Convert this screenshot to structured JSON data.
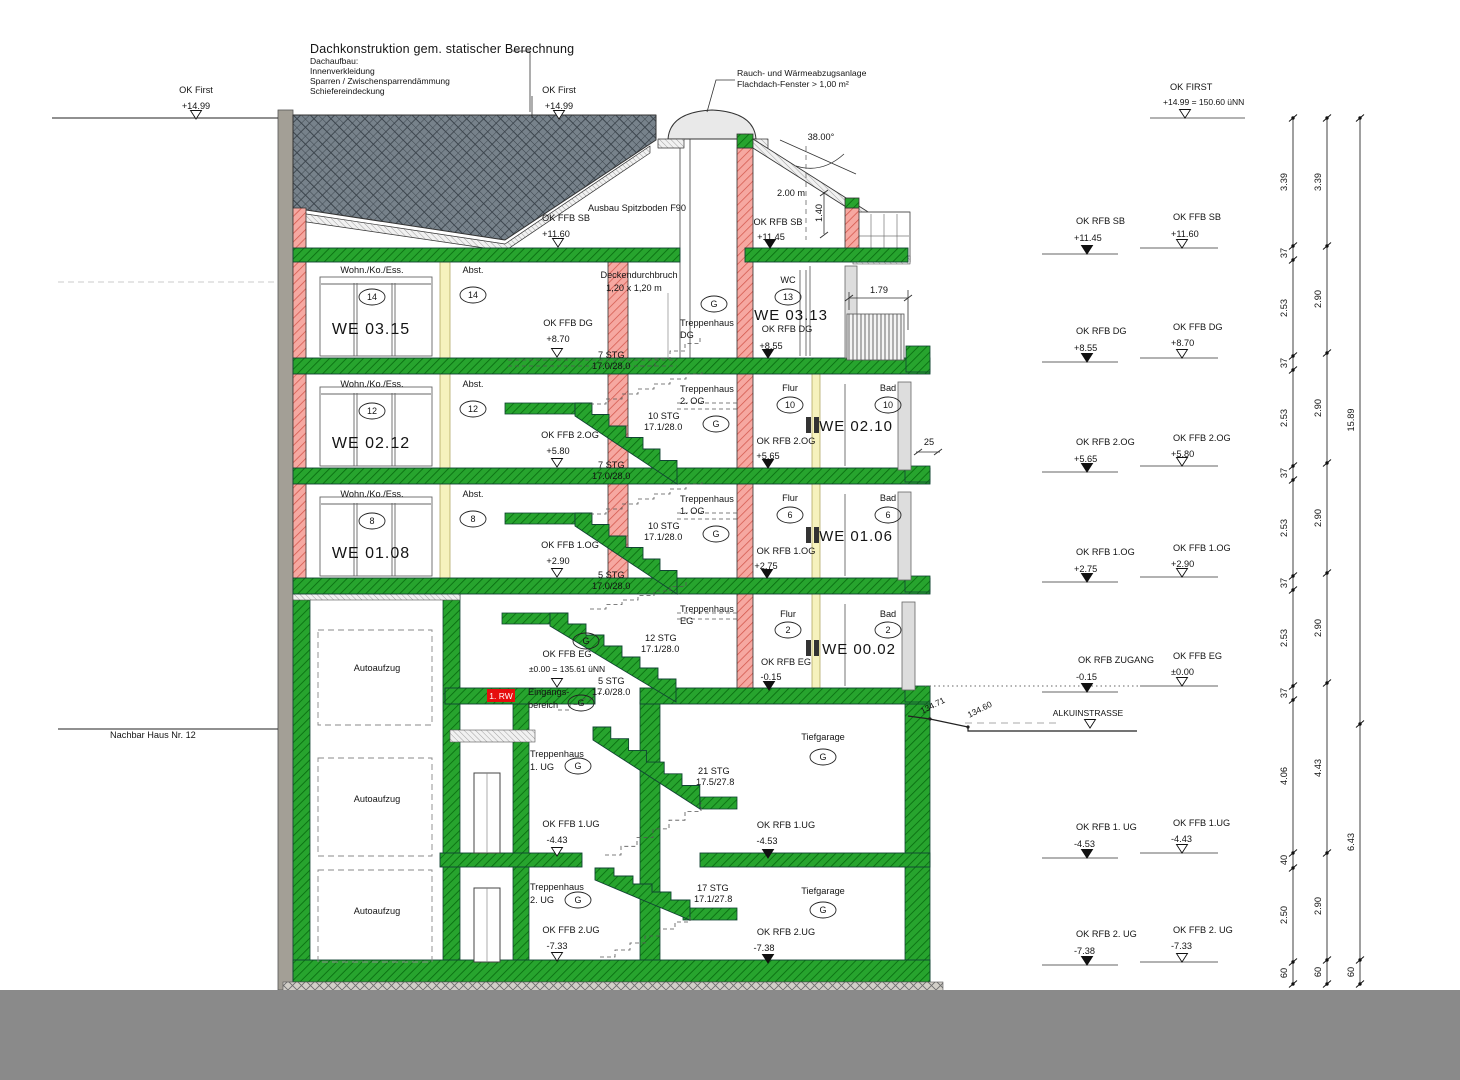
{
  "notes": {
    "roof_note": {
      "title": "Dachkonstruktion gem. statischer Berechnung",
      "lines": [
        "Dachaufbau:",
        "Innenverkleidung",
        "Sparren / Zwischensparrendämmung",
        "Schiefereindeckung"
      ]
    },
    "rwa_note": {
      "line1": "Rauch- und Wärmeabzugsanlage",
      "line2": "Flachdach-Fenster > 1,00 m²"
    }
  },
  "colors": {
    "concrete_green": "#1f9e28",
    "masonry_red": "#f5a29b",
    "roof_gray": "#77828b",
    "escape_red": "#e60d0d",
    "ground_gray": "#8a8a8a"
  },
  "texts": [
    {
      "n": "ok-first-left-label",
      "t": "OK First",
      "x": 196,
      "y": 93
    },
    {
      "n": "ok-first-left-value",
      "t": "+14.99",
      "x": 196,
      "y": 109
    },
    {
      "n": "ok-first-mid-label",
      "t": "OK First",
      "x": 559,
      "y": 93
    },
    {
      "n": "ok-first-mid-value",
      "t": "+14.99",
      "x": 559,
      "y": 109
    },
    {
      "n": "ok-ffb-sb",
      "t": "OK FFB SB",
      "x": 566,
      "y": 221
    },
    {
      "n": "ok-ffb-sb-value",
      "t": "+11.60",
      "x": 556,
      "y": 237
    },
    {
      "n": "spitzboden-note",
      "t": "Ausbau Spitzboden F90",
      "x": 637,
      "y": 211
    },
    {
      "n": "ok-rfb-sb",
      "t": "OK RFB SB",
      "x": 778,
      "y": 225
    },
    {
      "n": "ok-rfb-sb-value",
      "t": "+11.45",
      "x": 771,
      "y": 240
    },
    {
      "n": "roof-angle",
      "t": "38.00°",
      "x": 821,
      "y": 140
    },
    {
      "n": "headroom-dim",
      "t": "2.00 m",
      "x": 791,
      "y": 196
    },
    {
      "n": "dim-1-40",
      "t": "1.40",
      "x": 822,
      "y": 213,
      "r": -90
    },
    {
      "n": "dim-1-79",
      "t": "1.79",
      "x": 879,
      "y": 293
    },
    {
      "t": "Wohn./Ko./Ess.",
      "x": 372,
      "y": 273
    },
    {
      "n": "we-0315",
      "t": "WE 03.15",
      "x": 371,
      "y": 334,
      "s": 16
    },
    {
      "t": "Abst.",
      "x": 473,
      "y": 273
    },
    {
      "t": "Deckendurchbruch",
      "x": 639,
      "y": 278
    },
    {
      "t": "1,20 x 1,20 m",
      "x": 634,
      "y": 291
    },
    {
      "t": "OK FFB DG",
      "x": 568,
      "y": 326
    },
    {
      "t": "+8.70",
      "x": 558,
      "y": 342
    },
    {
      "t": "Treppenhaus",
      "x": 680,
      "y": 326,
      "a": "s"
    },
    {
      "t": "DG",
      "x": 680,
      "y": 338,
      "a": "s"
    },
    {
      "t": "7 STG",
      "x": 598,
      "y": 358,
      "a": "s"
    },
    {
      "t": "17.0/28.0",
      "x": 592,
      "y": 369,
      "a": "s"
    },
    {
      "t": "WC",
      "x": 788,
      "y": 283
    },
    {
      "n": "we-0313",
      "t": "WE 03.13",
      "x": 791,
      "y": 320,
      "s": 15
    },
    {
      "t": "OK RFB DG",
      "x": 787,
      "y": 332
    },
    {
      "t": "+8.55",
      "x": 771,
      "y": 349
    },
    {
      "t": "Wohn./Ko./Ess.",
      "x": 372,
      "y": 387
    },
    {
      "n": "we-0212",
      "t": "WE 02.12",
      "x": 371,
      "y": 448,
      "s": 16
    },
    {
      "t": "Abst.",
      "x": 473,
      "y": 387
    },
    {
      "t": "Treppenhaus",
      "x": 680,
      "y": 392,
      "a": "s"
    },
    {
      "t": "2. OG",
      "x": 680,
      "y": 404,
      "a": "s"
    },
    {
      "t": "10 STG",
      "x": 648,
      "y": 419,
      "a": "s"
    },
    {
      "t": "17.1/28.0",
      "x": 644,
      "y": 430,
      "a": "s"
    },
    {
      "t": "OK FFB 2.OG",
      "x": 570,
      "y": 438
    },
    {
      "t": "+5.80",
      "x": 558,
      "y": 454
    },
    {
      "t": "7 STG",
      "x": 598,
      "y": 468,
      "a": "s"
    },
    {
      "t": "17.0/28.0",
      "x": 592,
      "y": 479,
      "a": "s"
    },
    {
      "t": "Flur",
      "x": 790,
      "y": 391
    },
    {
      "n": "we-0210",
      "t": "WE 02.10",
      "x": 856,
      "y": 431,
      "s": 15
    },
    {
      "t": "Bad",
      "x": 888,
      "y": 391
    },
    {
      "t": "OK RFB 2.OG",
      "x": 786,
      "y": 444
    },
    {
      "t": "+5.65",
      "x": 768,
      "y": 459
    },
    {
      "n": "dim-25",
      "t": "25",
      "x": 929,
      "y": 445
    },
    {
      "t": "Wohn./Ko./Ess.",
      "x": 372,
      "y": 497
    },
    {
      "n": "we-0108",
      "t": "WE 01.08",
      "x": 371,
      "y": 558,
      "s": 16
    },
    {
      "t": "Abst.",
      "x": 473,
      "y": 497
    },
    {
      "t": "Treppenhaus",
      "x": 680,
      "y": 502,
      "a": "s"
    },
    {
      "t": "1. OG",
      "x": 680,
      "y": 514,
      "a": "s"
    },
    {
      "t": "10 STG",
      "x": 648,
      "y": 529,
      "a": "s"
    },
    {
      "t": "17.1/28.0",
      "x": 644,
      "y": 540,
      "a": "s"
    },
    {
      "t": "OK FFB 1.OG",
      "x": 570,
      "y": 548
    },
    {
      "t": "+2.90",
      "x": 558,
      "y": 564
    },
    {
      "t": "5 STG",
      "x": 598,
      "y": 578,
      "a": "s"
    },
    {
      "t": "17.0/28.0",
      "x": 592,
      "y": 589,
      "a": "s"
    },
    {
      "t": "Flur",
      "x": 790,
      "y": 501
    },
    {
      "n": "we-0106",
      "t": "WE 01.06",
      "x": 856,
      "y": 541,
      "s": 15
    },
    {
      "t": "Bad",
      "x": 888,
      "y": 501
    },
    {
      "t": "OK RFB 1.OG",
      "x": 786,
      "y": 554
    },
    {
      "t": "+2.75",
      "x": 766,
      "y": 569
    },
    {
      "t": "Treppenhaus",
      "x": 680,
      "y": 612,
      "a": "s"
    },
    {
      "t": "EG",
      "x": 680,
      "y": 624,
      "a": "s"
    },
    {
      "t": "12 STG",
      "x": 645,
      "y": 641,
      "a": "s"
    },
    {
      "t": "17.1/28.0",
      "x": 641,
      "y": 652,
      "a": "s"
    },
    {
      "t": "OK FFB EG",
      "x": 567,
      "y": 657
    },
    {
      "t": "±0.00 = 135.61 üNN",
      "x": 567,
      "y": 672,
      "s": 8.5
    },
    {
      "t": "5 STG",
      "x": 598,
      "y": 684,
      "a": "s"
    },
    {
      "t": "17.0/28.0",
      "x": 592,
      "y": 695,
      "a": "s"
    },
    {
      "t": "Eingangs-",
      "x": 528,
      "y": 695,
      "a": "s"
    },
    {
      "t": "bereich",
      "x": 528,
      "y": 708,
      "a": "s"
    },
    {
      "n": "escape-route-badge",
      "t": "1. RW",
      "x": 501,
      "y": 699,
      "s": 8.5,
      "c": "#ffffff"
    },
    {
      "t": "Flur",
      "x": 788,
      "y": 617
    },
    {
      "n": "we-0002",
      "t": "WE 00.02",
      "x": 859,
      "y": 654,
      "s": 15
    },
    {
      "t": "Bad",
      "x": 888,
      "y": 617
    },
    {
      "t": "OK RFB EG",
      "x": 786,
      "y": 665
    },
    {
      "t": "-0.15",
      "x": 771,
      "y": 680
    },
    {
      "t": "Treppenhaus",
      "x": 530,
      "y": 757,
      "a": "s"
    },
    {
      "t": "1. UG",
      "x": 530,
      "y": 770,
      "a": "s"
    },
    {
      "t": "21 STG",
      "x": 698,
      "y": 774,
      "a": "s"
    },
    {
      "t": "17.5/27.8",
      "x": 696,
      "y": 785,
      "a": "s"
    },
    {
      "t": "Tiefgarage",
      "x": 823,
      "y": 740
    },
    {
      "t": "OK FFB 1.UG",
      "x": 571,
      "y": 827
    },
    {
      "t": "-4.43",
      "x": 557,
      "y": 843
    },
    {
      "t": "OK RFB 1.UG",
      "x": 786,
      "y": 828
    },
    {
      "t": "-4.53",
      "x": 767,
      "y": 844
    },
    {
      "t": "Treppenhaus",
      "x": 530,
      "y": 890,
      "a": "s"
    },
    {
      "t": "2. UG",
      "x": 530,
      "y": 903,
      "a": "s"
    },
    {
      "t": "17 STG",
      "x": 697,
      "y": 891,
      "a": "s"
    },
    {
      "t": "17.1/27.8",
      "x": 694,
      "y": 902,
      "a": "s"
    },
    {
      "t": "Tiefgarage",
      "x": 823,
      "y": 894
    },
    {
      "t": "OK FFB 2.UG",
      "x": 571,
      "y": 933
    },
    {
      "t": "-7.33",
      "x": 557,
      "y": 949
    },
    {
      "t": "OK RFB 2.UG",
      "x": 786,
      "y": 935
    },
    {
      "t": "-7.38",
      "x": 764,
      "y": 951
    },
    {
      "n": "autoaufzug-eg",
      "t": "Autoaufzug",
      "x": 377,
      "y": 671
    },
    {
      "n": "autoaufzug-1ug",
      "t": "Autoaufzug",
      "x": 377,
      "y": 802
    },
    {
      "n": "autoaufzug-2ug",
      "t": "Autoaufzug",
      "x": 377,
      "y": 914
    },
    {
      "n": "neighbor-label",
      "t": "Nachbar Haus Nr. 12",
      "x": 110,
      "y": 738,
      "a": "s"
    },
    {
      "n": "spot-13471",
      "t": "134.71",
      "x": 934,
      "y": 708,
      "r": -27,
      "s": 8.5
    },
    {
      "n": "spot-13460",
      "t": "134.60",
      "x": 981,
      "y": 712,
      "r": -27,
      "s": 8.5
    },
    {
      "t": "OK FIRST",
      "x": 1170,
      "y": 90,
      "a": "s"
    },
    {
      "t": "+14.99 = 150.60 üNN",
      "x": 1163,
      "y": 105,
      "a": "s",
      "s": 8.5
    },
    {
      "t": "OK RFB SB",
      "x": 1076,
      "y": 224,
      "a": "s"
    },
    {
      "t": "+11.45",
      "x": 1074,
      "y": 241,
      "a": "s"
    },
    {
      "t": "OK FFB SB",
      "x": 1173,
      "y": 220,
      "a": "s"
    },
    {
      "t": "+11.60",
      "x": 1171,
      "y": 237,
      "a": "s"
    },
    {
      "t": "OK RFB DG",
      "x": 1076,
      "y": 334,
      "a": "s"
    },
    {
      "t": "+8.55",
      "x": 1074,
      "y": 351,
      "a": "s"
    },
    {
      "t": "OK FFB DG",
      "x": 1173,
      "y": 330,
      "a": "s"
    },
    {
      "t": "+8.70",
      "x": 1171,
      "y": 346,
      "a": "s"
    },
    {
      "t": "OK RFB 2.OG",
      "x": 1076,
      "y": 445,
      "a": "s"
    },
    {
      "t": "+5.65",
      "x": 1074,
      "y": 462,
      "a": "s"
    },
    {
      "t": "OK FFB 2.OG",
      "x": 1173,
      "y": 441,
      "a": "s"
    },
    {
      "t": "+5.80",
      "x": 1171,
      "y": 457,
      "a": "s"
    },
    {
      "t": "OK RFB 1.OG",
      "x": 1076,
      "y": 555,
      "a": "s"
    },
    {
      "t": "+2.75",
      "x": 1074,
      "y": 572,
      "a": "s"
    },
    {
      "t": "OK FFB 1.OG",
      "x": 1173,
      "y": 551,
      "a": "s"
    },
    {
      "t": "+2.90",
      "x": 1171,
      "y": 567,
      "a": "s"
    },
    {
      "t": "OK RFB ZUGANG",
      "x": 1078,
      "y": 663,
      "a": "s"
    },
    {
      "t": "-0.15",
      "x": 1076,
      "y": 680,
      "a": "s"
    },
    {
      "t": "OK FFB EG",
      "x": 1173,
      "y": 659,
      "a": "s"
    },
    {
      "t": "±0.00",
      "x": 1171,
      "y": 675,
      "a": "s"
    },
    {
      "n": "street-label",
      "t": "ALKUINSTRASSE",
      "x": 1088,
      "y": 716,
      "s": 8.5
    },
    {
      "t": "OK RFB 1. UG",
      "x": 1076,
      "y": 830,
      "a": "s"
    },
    {
      "t": "-4.53",
      "x": 1074,
      "y": 847,
      "a": "s"
    },
    {
      "t": "OK FFB 1.UG",
      "x": 1173,
      "y": 826,
      "a": "s"
    },
    {
      "t": "-4.43",
      "x": 1171,
      "y": 842,
      "a": "s"
    },
    {
      "t": "OK RFB 2. UG",
      "x": 1076,
      "y": 937,
      "a": "s"
    },
    {
      "t": "-7.38",
      "x": 1074,
      "y": 954,
      "a": "s"
    },
    {
      "t": "OK FFB 2. UG",
      "x": 1173,
      "y": 933,
      "a": "s"
    },
    {
      "t": "-7.33",
      "x": 1171,
      "y": 949,
      "a": "s"
    }
  ],
  "ovals": [
    {
      "t": "14",
      "x": 372,
      "y": 297
    },
    {
      "t": "14",
      "x": 473,
      "y": 295
    },
    {
      "t": "G",
      "x": 714,
      "y": 304
    },
    {
      "t": "13",
      "x": 788,
      "y": 297
    },
    {
      "t": "12",
      "x": 372,
      "y": 411
    },
    {
      "t": "12",
      "x": 473,
      "y": 409
    },
    {
      "t": "G",
      "x": 716,
      "y": 424
    },
    {
      "t": "10",
      "x": 790,
      "y": 405
    },
    {
      "t": "10",
      "x": 888,
      "y": 405
    },
    {
      "t": "8",
      "x": 372,
      "y": 521
    },
    {
      "t": "8",
      "x": 473,
      "y": 519
    },
    {
      "t": "G",
      "x": 716,
      "y": 534
    },
    {
      "t": "6",
      "x": 790,
      "y": 515
    },
    {
      "t": "6",
      "x": 888,
      "y": 515
    },
    {
      "t": "G",
      "x": 586,
      "y": 641
    },
    {
      "t": "2",
      "x": 788,
      "y": 630
    },
    {
      "t": "2",
      "x": 888,
      "y": 630
    },
    {
      "t": "G",
      "x": 581,
      "y": 703
    },
    {
      "t": "G",
      "x": 578,
      "y": 766
    },
    {
      "t": "G",
      "x": 823,
      "y": 757
    },
    {
      "t": "G",
      "x": 578,
      "y": 900
    },
    {
      "t": "G",
      "x": 823,
      "y": 910
    }
  ],
  "level_markers": [
    {
      "x": 196,
      "y": 119,
      "f": false
    },
    {
      "x": 559,
      "y": 119,
      "f": false
    },
    {
      "x": 558,
      "y": 247,
      "f": false
    },
    {
      "x": 770,
      "y": 248,
      "f": true
    },
    {
      "x": 557,
      "y": 357,
      "f": false
    },
    {
      "x": 768,
      "y": 358,
      "f": true
    },
    {
      "x": 557,
      "y": 467,
      "f": false
    },
    {
      "x": 768,
      "y": 468,
      "f": true
    },
    {
      "x": 557,
      "y": 577,
      "f": false
    },
    {
      "x": 767,
      "y": 578,
      "f": true
    },
    {
      "x": 557,
      "y": 687,
      "f": false
    },
    {
      "x": 769,
      "y": 690,
      "f": true
    },
    {
      "x": 557,
      "y": 856,
      "f": false
    },
    {
      "x": 768,
      "y": 858,
      "f": true
    },
    {
      "x": 557,
      "y": 961,
      "f": false
    },
    {
      "x": 768,
      "y": 963,
      "f": true
    },
    {
      "x": 1185,
      "y": 118,
      "f": false
    },
    {
      "x": 1087,
      "y": 254,
      "f": true
    },
    {
      "x": 1182,
      "y": 248,
      "f": false
    },
    {
      "x": 1087,
      "y": 362,
      "f": true
    },
    {
      "x": 1182,
      "y": 358,
      "f": false
    },
    {
      "x": 1087,
      "y": 472,
      "f": true
    },
    {
      "x": 1182,
      "y": 466,
      "f": false
    },
    {
      "x": 1087,
      "y": 582,
      "f": true
    },
    {
      "x": 1182,
      "y": 577,
      "f": false
    },
    {
      "x": 1087,
      "y": 692,
      "f": true
    },
    {
      "x": 1182,
      "y": 686,
      "f": false
    },
    {
      "x": 1090,
      "y": 728,
      "f": false
    },
    {
      "x": 1087,
      "y": 858,
      "f": true
    },
    {
      "x": 1182,
      "y": 853,
      "f": false
    },
    {
      "x": 1087,
      "y": 965,
      "f": true
    },
    {
      "x": 1182,
      "y": 962,
      "f": false
    }
  ],
  "dim_chains": [
    {
      "x": 1293,
      "ticks": [
        118,
        246,
        260,
        356,
        370,
        466,
        480,
        576,
        590,
        686,
        700,
        853,
        868,
        962,
        984
      ],
      "labels": [
        {
          "t": "3.39",
          "y": 182
        },
        {
          "t": "37",
          "y": 253
        },
        {
          "t": "2.53",
          "y": 308
        },
        {
          "t": "37",
          "y": 363
        },
        {
          "t": "2.53",
          "y": 418
        },
        {
          "t": "37",
          "y": 473
        },
        {
          "t": "2.53",
          "y": 528
        },
        {
          "t": "37",
          "y": 583
        },
        {
          "t": "2.53",
          "y": 638
        },
        {
          "t": "37",
          "y": 693
        },
        {
          "t": "4.06",
          "y": 776
        },
        {
          "t": "40",
          "y": 860
        },
        {
          "t": "2.50",
          "y": 915
        },
        {
          "t": "60",
          "y": 973
        }
      ]
    },
    {
      "x": 1327,
      "ticks": [
        118,
        246,
        353,
        463,
        573,
        683,
        853,
        960,
        984
      ],
      "labels": [
        {
          "t": "3.39",
          "y": 182
        },
        {
          "t": "2.90",
          "y": 299
        },
        {
          "t": "2.90",
          "y": 408
        },
        {
          "t": "2.90",
          "y": 518
        },
        {
          "t": "2.90",
          "y": 628
        },
        {
          "t": "4.43",
          "y": 768
        },
        {
          "t": "2.90",
          "y": 906
        },
        {
          "t": "60",
          "y": 972
        }
      ]
    },
    {
      "x": 1360,
      "ticks": [
        118,
        724,
        960,
        984
      ],
      "labels": [
        {
          "t": "15.89",
          "y": 420
        },
        {
          "t": "6.43",
          "y": 842
        },
        {
          "t": "60",
          "y": 972
        }
      ]
    }
  ]
}
